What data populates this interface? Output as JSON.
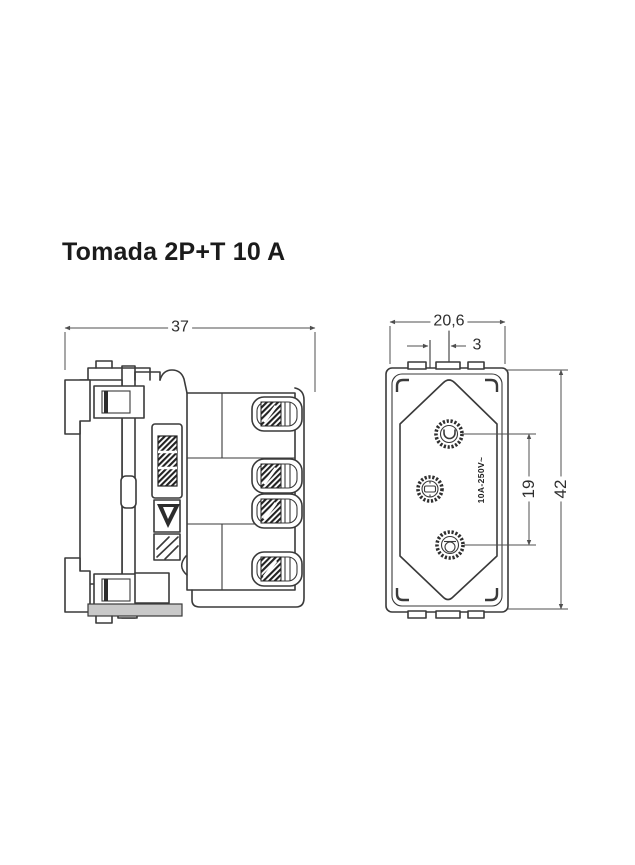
{
  "title": "Tomada 2P+T 10 A",
  "colors": {
    "background": "#ffffff",
    "line": "#3a3a3a",
    "dimension_line": "#4f4f4f",
    "title_text": "#1b1b1b",
    "shading": "#c9c9c9"
  },
  "views": {
    "side": {
      "description": "side-section-view",
      "dim_width": "37"
    },
    "front": {
      "description": "front-view-socket-face",
      "dim_width": "20,6",
      "dim_earth_offset": "3",
      "dim_pin_spacing": "19",
      "dim_height": "42",
      "marking": "10A-250V~"
    }
  }
}
